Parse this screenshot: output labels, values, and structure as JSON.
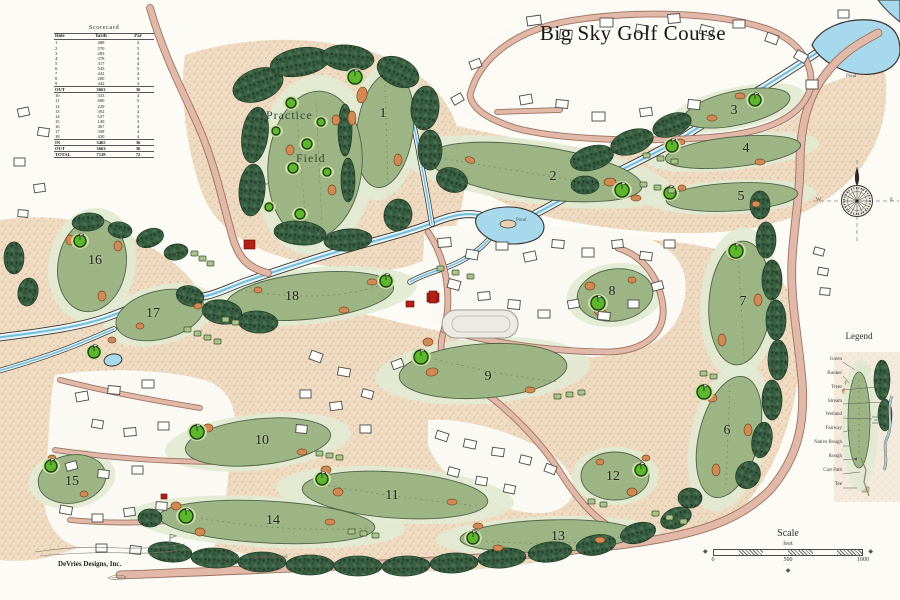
{
  "title": "Big Sky Golf Course",
  "scorecard": {
    "title": "Scorecard",
    "headers": [
      "Hole",
      "Yards",
      "Par"
    ],
    "rows": [
      [
        "1",
        "488",
        "4"
      ],
      [
        "2",
        "570",
        "5"
      ],
      [
        "3",
        "283",
        "3"
      ],
      [
        "4",
        "378",
        "4"
      ],
      [
        "5",
        "317",
        "4"
      ],
      [
        "6",
        "543",
        "5"
      ],
      [
        "7",
        "442",
        "4"
      ],
      [
        "8",
        "200",
        "3"
      ],
      [
        "9",
        "442",
        "4"
      ],
      [
        "OUT",
        "3663",
        "36"
      ],
      [
        "10",
        "333",
        "4"
      ],
      [
        "11",
        "600",
        "5"
      ],
      [
        "12",
        "229",
        "3"
      ],
      [
        "13",
        "392",
        "4"
      ],
      [
        "14",
        "527",
        "5"
      ],
      [
        "15",
        "149",
        "3"
      ],
      [
        "16",
        "467",
        "4"
      ],
      [
        "17",
        "338",
        "4"
      ],
      [
        "18",
        "430",
        "4"
      ],
      [
        "IN",
        "3465",
        "36"
      ],
      [
        "OUT",
        "3663",
        "36"
      ],
      [
        "TOTAL",
        "7128",
        "72"
      ]
    ]
  },
  "holes": [
    {
      "n": "1",
      "x": 383,
      "y": 115
    },
    {
      "n": "2",
      "x": 553,
      "y": 178
    },
    {
      "n": "3",
      "x": 734,
      "y": 112
    },
    {
      "n": "4",
      "x": 746,
      "y": 150
    },
    {
      "n": "5",
      "x": 741,
      "y": 198
    },
    {
      "n": "6",
      "x": 727,
      "y": 432
    },
    {
      "n": "7",
      "x": 743,
      "y": 303
    },
    {
      "n": "8",
      "x": 612,
      "y": 293
    },
    {
      "n": "9",
      "x": 488,
      "y": 378
    },
    {
      "n": "10",
      "x": 262,
      "y": 442
    },
    {
      "n": "11",
      "x": 392,
      "y": 497
    },
    {
      "n": "12",
      "x": 613,
      "y": 478
    },
    {
      "n": "13",
      "x": 558,
      "y": 538
    },
    {
      "n": "14",
      "x": 273,
      "y": 522
    },
    {
      "n": "15",
      "x": 72,
      "y": 483
    },
    {
      "n": "16",
      "x": 95,
      "y": 262
    },
    {
      "n": "17",
      "x": 153,
      "y": 315
    },
    {
      "n": "18",
      "x": 292,
      "y": 298
    }
  ],
  "labels": {
    "practice_1": "Practice",
    "practice_2": "Field",
    "short_game_1": "Short Game",
    "short_game_2": "Area",
    "pond_center": "Pond",
    "pond_topright": "Pond",
    "road": "Big Sky Spur Road",
    "credit": "DeVries Designs, Inc."
  },
  "legend": {
    "title": "Legend",
    "items": [
      "Green",
      "Bunker",
      "Trees",
      "Stream",
      "Wetland",
      "Fairway",
      "Native Rough",
      "Rough",
      "Cart Path",
      "Tee"
    ]
  },
  "compass": {
    "w": "W",
    "e": "E"
  },
  "scale": {
    "title": "Scale",
    "unit": "feet",
    "ticks": [
      "0",
      "500",
      "1000"
    ]
  },
  "icons": {
    "scale_end_left": "◆",
    "scale_end_right": "◆",
    "ornament": "◆"
  },
  "colors": {
    "fairway": "#9db584",
    "green": "#5cb82a",
    "trees": "#3c6044",
    "stream": "#74bedd",
    "road": "#e2b9a8",
    "bunker": "#d28a54",
    "native_rough": "#edd8bd"
  }
}
